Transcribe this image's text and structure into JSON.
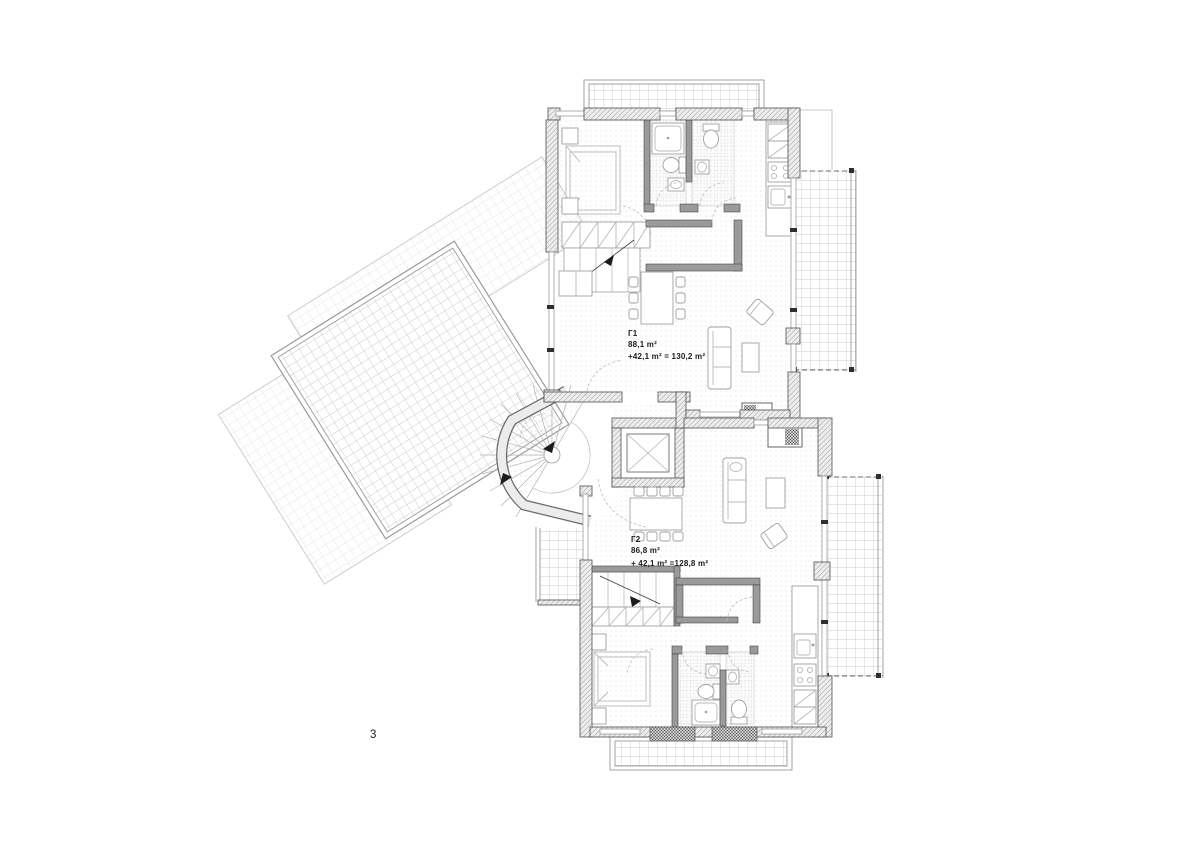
{
  "sheet": {
    "number": "3"
  },
  "apartments": [
    {
      "id": "Г1",
      "area": "88,1 m²",
      "total": "+42,1 m² = 130,2 m²"
    },
    {
      "id": "Г2",
      "area": "86,8 m²",
      "total": "+ 42,1 m² =128,8 m²"
    }
  ],
  "colors": {
    "ink": "#1c1c1c",
    "wall_hatch": "#a6a6a6",
    "terrace_grid": "#bcbcbc",
    "floor_dots": "#c9c9c9"
  }
}
